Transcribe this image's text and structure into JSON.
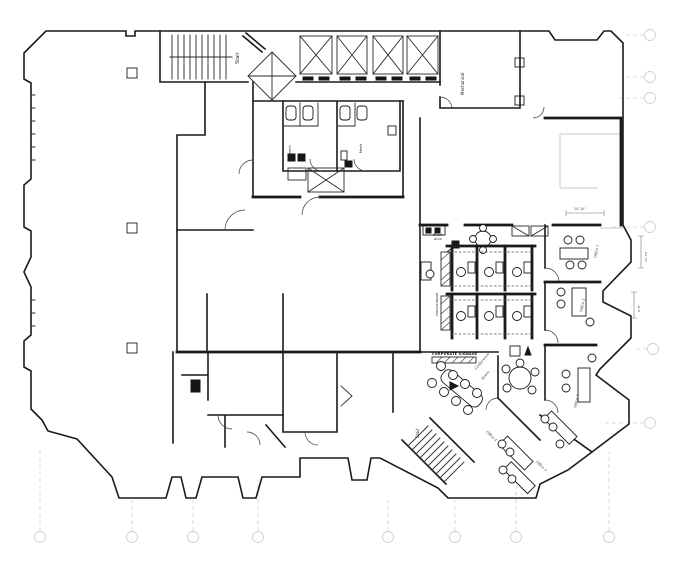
{
  "colors": {
    "wall": "#1a1a1a",
    "shell_light": "#c9c9c9",
    "grid_marker": "#d0d0d0",
    "background": "#ffffff",
    "fixture_fill": "#161616"
  },
  "labels": [
    {
      "text": "Stair"
    },
    {
      "text": "Mechanical"
    },
    {
      "text": "Women's"
    },
    {
      "text": "Men's"
    },
    {
      "text": "Break"
    },
    {
      "text": "Area"
    },
    {
      "text": "FILES/STORAGE"
    },
    {
      "text": "CORPORATE SIGNAGE"
    },
    {
      "text": "Conference"
    },
    {
      "text": "Room"
    },
    {
      "text": "Stair"
    },
    {
      "text": "Office 1"
    },
    {
      "text": "Office 2"
    },
    {
      "text": "Office 3"
    },
    {
      "text": "Office 4"
    },
    {
      "text": "Office 5"
    },
    {
      "text": "14'-10\""
    },
    {
      "text": "16'-10\""
    },
    {
      "text": "9'-8\""
    }
  ],
  "grid": {
    "bottom_marker_count": 8,
    "right_marker_count": 6
  }
}
